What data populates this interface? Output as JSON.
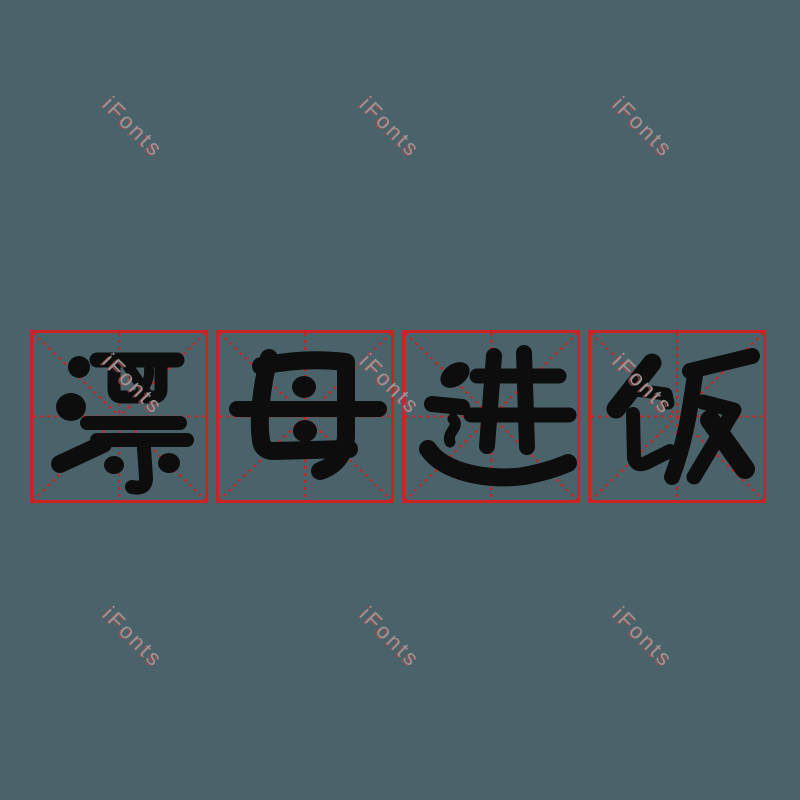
{
  "page": {
    "type": "font-preview-image",
    "background_color": "#4a636b"
  },
  "watermark": {
    "text": "iFonts",
    "count": 9,
    "rotation_deg": 45,
    "color": "#939899",
    "shadow_color": "#a74646"
  },
  "grid": {
    "style": "mi-zi-ge practice squares",
    "box_count": 4,
    "line_color": "#cb2323",
    "border": "solid",
    "inner_lines": "dashed diagonals and center cross"
  },
  "phrase": {
    "text": "漂母进饭"
  },
  "boxes": [
    {
      "char": "漂"
    },
    {
      "char": "母"
    },
    {
      "char": "进"
    },
    {
      "char": "饭"
    }
  ],
  "glyph_color": "#0d0d0d"
}
